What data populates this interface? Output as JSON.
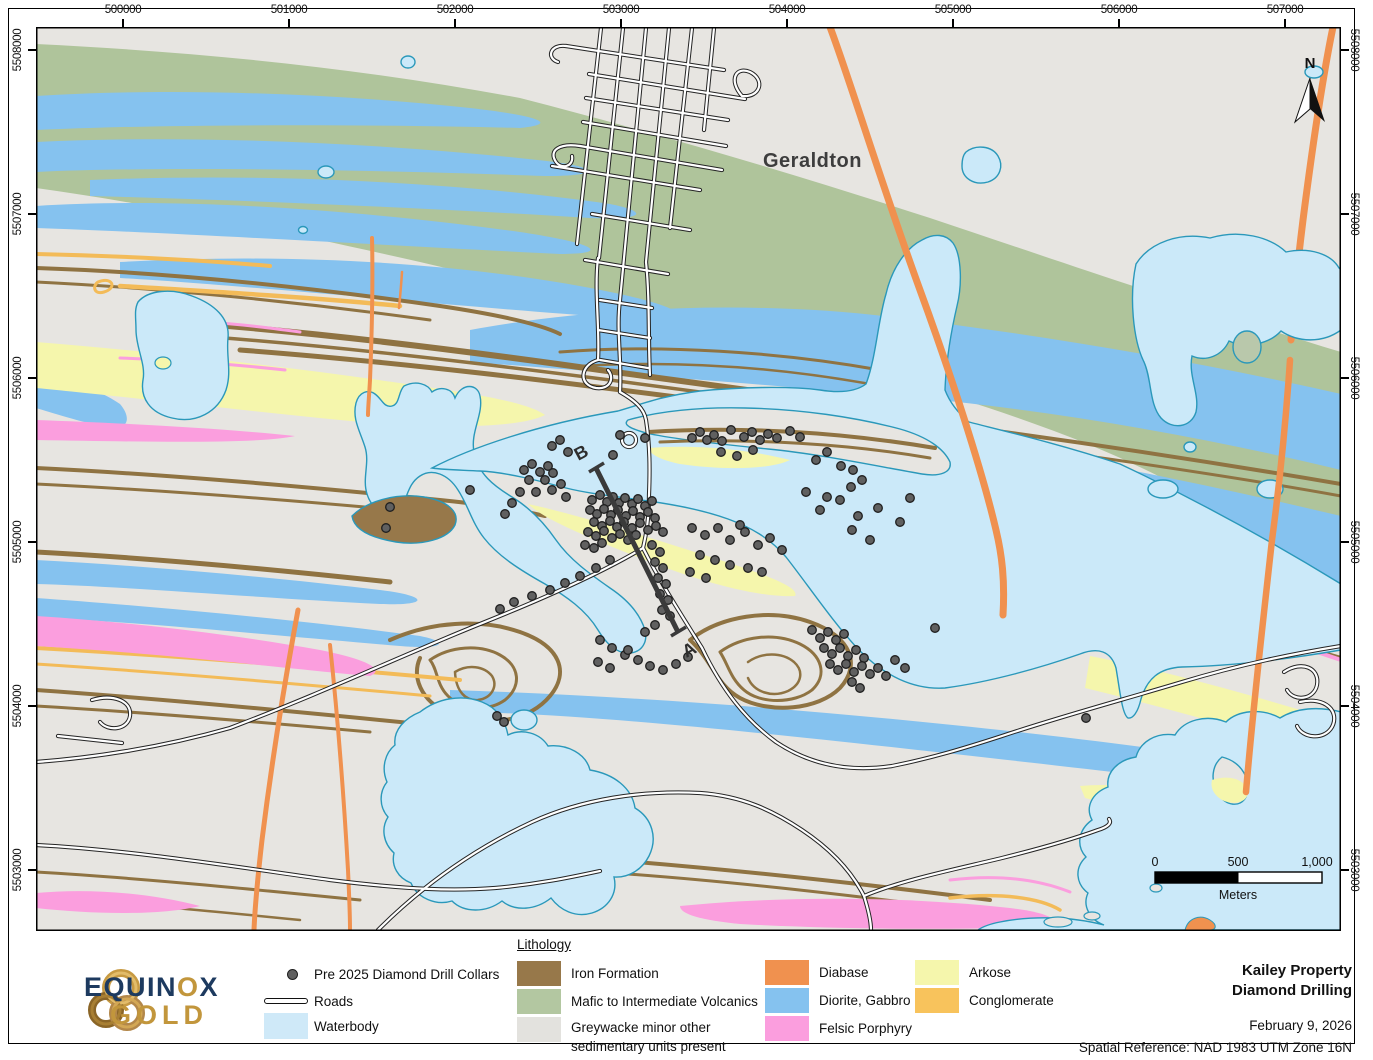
{
  "axes": {
    "top": [
      "500000",
      "501000",
      "502000",
      "503000",
      "504000",
      "505000",
      "506000",
      "507000"
    ],
    "left": [
      "5508000",
      "5507000",
      "5506000",
      "5505000",
      "5504000",
      "5503000"
    ],
    "right": [
      "5508000",
      "5507000",
      "5506000",
      "5505000",
      "5504000",
      "5503000"
    ]
  },
  "map_labels": {
    "town": "Geraldton",
    "section_a": "A",
    "section_b": "B",
    "north": "N"
  },
  "scalebar": {
    "labels": [
      "0",
      "500",
      "1,000"
    ],
    "unit": "Meters"
  },
  "legend": {
    "collars_label": "Pre 2025 Diamond Drill Collars",
    "roads_label": "Roads",
    "waterbody_label": "Waterbody",
    "waterbody_color": "#cfe9f8",
    "lithology_title": "Lithology",
    "items": [
      {
        "label": "Iron Formation",
        "color": "#97784a"
      },
      {
        "label": "Mafic to Intermediate Volcanics",
        "color": "#b3c7a1"
      },
      {
        "label": "Greywacke minor other sedimentary units present",
        "color": "#e3e2de"
      },
      {
        "label": "Diabase",
        "color": "#f0914f"
      },
      {
        "label": "Diorite, Gabbro",
        "color": "#85c2ef"
      },
      {
        "label": "Felsic Porphyry",
        "color": "#fb9ede"
      },
      {
        "label": "Arkose",
        "color": "#f5f6ac"
      },
      {
        "label": "Conglomerate",
        "color": "#f8c35c"
      }
    ]
  },
  "title_block": {
    "line1": "Kailey Property",
    "line2": "Diamond Drilling",
    "date": "February 9, 2026",
    "spatial_ref": "Spatial Reference: NAD 1983 UTM Zone 16N"
  },
  "logo": {
    "name_parts": [
      "EQUIN",
      "O",
      "X"
    ],
    "name_bottom": "GOLD"
  },
  "drill_collars": [
    [
      692,
      438
    ],
    [
      700,
      432
    ],
    [
      707,
      440
    ],
    [
      714,
      435
    ],
    [
      722,
      441
    ],
    [
      731,
      430
    ],
    [
      744,
      437
    ],
    [
      752,
      432
    ],
    [
      760,
      440
    ],
    [
      768,
      434
    ],
    [
      777,
      438
    ],
    [
      790,
      431
    ],
    [
      800,
      437
    ],
    [
      721,
      452
    ],
    [
      737,
      456
    ],
    [
      753,
      450
    ],
    [
      816,
      460
    ],
    [
      827,
      452
    ],
    [
      841,
      466
    ],
    [
      853,
      470
    ],
    [
      806,
      492
    ],
    [
      827,
      497
    ],
    [
      851,
      487
    ],
    [
      862,
      480
    ],
    [
      620,
      435
    ],
    [
      645,
      438
    ],
    [
      560,
      440
    ],
    [
      552,
      446
    ],
    [
      568,
      452
    ],
    [
      613,
      455
    ],
    [
      524,
      470
    ],
    [
      532,
      464
    ],
    [
      540,
      472
    ],
    [
      548,
      466
    ],
    [
      529,
      480
    ],
    [
      545,
      480
    ],
    [
      553,
      473
    ],
    [
      520,
      492
    ],
    [
      536,
      492
    ],
    [
      552,
      490
    ],
    [
      561,
      484
    ],
    [
      566,
      497
    ],
    [
      512,
      503
    ],
    [
      505,
      514
    ],
    [
      390,
      507
    ],
    [
      386,
      528
    ],
    [
      470,
      490
    ],
    [
      592,
      500
    ],
    [
      600,
      495
    ],
    [
      607,
      502
    ],
    [
      613,
      497
    ],
    [
      619,
      503
    ],
    [
      625,
      498
    ],
    [
      632,
      504
    ],
    [
      638,
      499
    ],
    [
      645,
      506
    ],
    [
      652,
      501
    ],
    [
      590,
      510
    ],
    [
      597,
      514
    ],
    [
      604,
      509
    ],
    [
      611,
      515
    ],
    [
      618,
      510
    ],
    [
      626,
      516
    ],
    [
      633,
      511
    ],
    [
      640,
      517
    ],
    [
      648,
      512
    ],
    [
      655,
      518
    ],
    [
      594,
      522
    ],
    [
      602,
      526
    ],
    [
      610,
      521
    ],
    [
      617,
      527
    ],
    [
      624,
      522
    ],
    [
      632,
      528
    ],
    [
      640,
      523
    ],
    [
      588,
      532
    ],
    [
      596,
      536
    ],
    [
      604,
      531
    ],
    [
      648,
      530
    ],
    [
      656,
      526
    ],
    [
      663,
      532
    ],
    [
      612,
      538
    ],
    [
      620,
      534
    ],
    [
      628,
      540
    ],
    [
      636,
      535
    ],
    [
      585,
      545
    ],
    [
      594,
      548
    ],
    [
      602,
      543
    ],
    [
      652,
      545
    ],
    [
      660,
      552
    ],
    [
      655,
      562
    ],
    [
      663,
      568
    ],
    [
      658,
      578
    ],
    [
      666,
      584
    ],
    [
      660,
      594
    ],
    [
      668,
      600
    ],
    [
      662,
      610
    ],
    [
      670,
      616
    ],
    [
      655,
      625
    ],
    [
      645,
      632
    ],
    [
      610,
      560
    ],
    [
      596,
      568
    ],
    [
      580,
      576
    ],
    [
      565,
      583
    ],
    [
      550,
      590
    ],
    [
      532,
      596
    ],
    [
      514,
      602
    ],
    [
      500,
      609
    ],
    [
      600,
      640
    ],
    [
      612,
      648
    ],
    [
      625,
      655
    ],
    [
      638,
      660
    ],
    [
      650,
      666
    ],
    [
      663,
      670
    ],
    [
      676,
      664
    ],
    [
      688,
      657
    ],
    [
      598,
      662
    ],
    [
      610,
      668
    ],
    [
      628,
      650
    ],
    [
      692,
      528
    ],
    [
      705,
      535
    ],
    [
      718,
      528
    ],
    [
      730,
      540
    ],
    [
      745,
      532
    ],
    [
      758,
      545
    ],
    [
      770,
      538
    ],
    [
      782,
      550
    ],
    [
      700,
      555
    ],
    [
      715,
      560
    ],
    [
      730,
      565
    ],
    [
      748,
      568
    ],
    [
      762,
      572
    ],
    [
      690,
      572
    ],
    [
      706,
      578
    ],
    [
      740,
      525
    ],
    [
      820,
      510
    ],
    [
      840,
      500
    ],
    [
      858,
      516
    ],
    [
      878,
      508
    ],
    [
      900,
      522
    ],
    [
      852,
      530
    ],
    [
      870,
      540
    ],
    [
      910,
      498
    ],
    [
      812,
      630
    ],
    [
      820,
      638
    ],
    [
      828,
      632
    ],
    [
      836,
      640
    ],
    [
      844,
      634
    ],
    [
      824,
      648
    ],
    [
      832,
      654
    ],
    [
      840,
      648
    ],
    [
      848,
      656
    ],
    [
      856,
      650
    ],
    [
      864,
      658
    ],
    [
      830,
      664
    ],
    [
      838,
      670
    ],
    [
      846,
      664
    ],
    [
      854,
      672
    ],
    [
      862,
      666
    ],
    [
      870,
      674
    ],
    [
      878,
      668
    ],
    [
      886,
      676
    ],
    [
      852,
      682
    ],
    [
      860,
      688
    ],
    [
      895,
      660
    ],
    [
      905,
      668
    ],
    [
      935,
      628
    ],
    [
      1086,
      718
    ],
    [
      497,
      716
    ],
    [
      504,
      722
    ]
  ]
}
